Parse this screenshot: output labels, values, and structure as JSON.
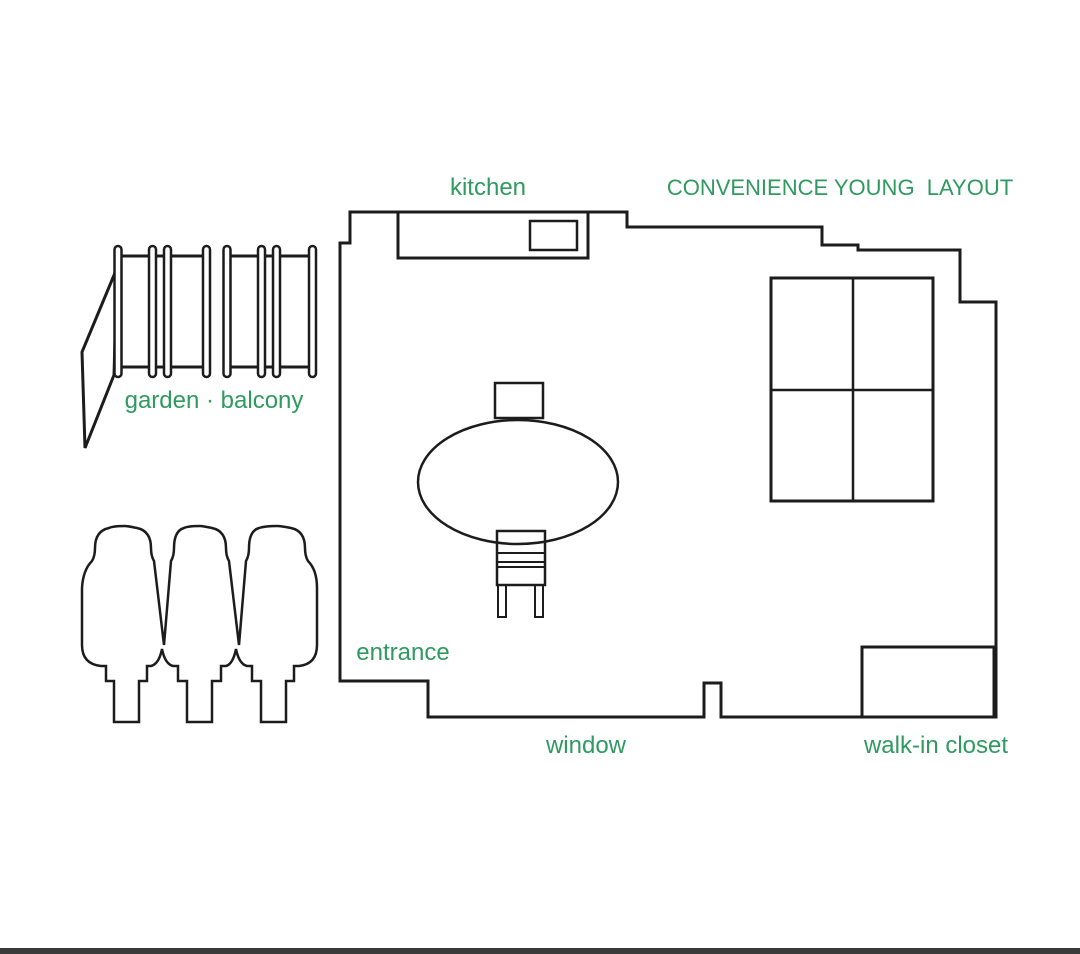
{
  "diagram": {
    "title": "CONVENIENCE YOUNG  LAYOUT",
    "labels": {
      "kitchen": "kitchen",
      "garden_balcony": "garden · balcony",
      "entrance": "entrance",
      "window": "window",
      "walk_in_closet": "walk-in closet"
    },
    "colors": {
      "label_green": "#2f9a5f",
      "line": "#1c1c1c",
      "background": "#ffffff",
      "bottom_bar": "#3b3b3b"
    }
  }
}
